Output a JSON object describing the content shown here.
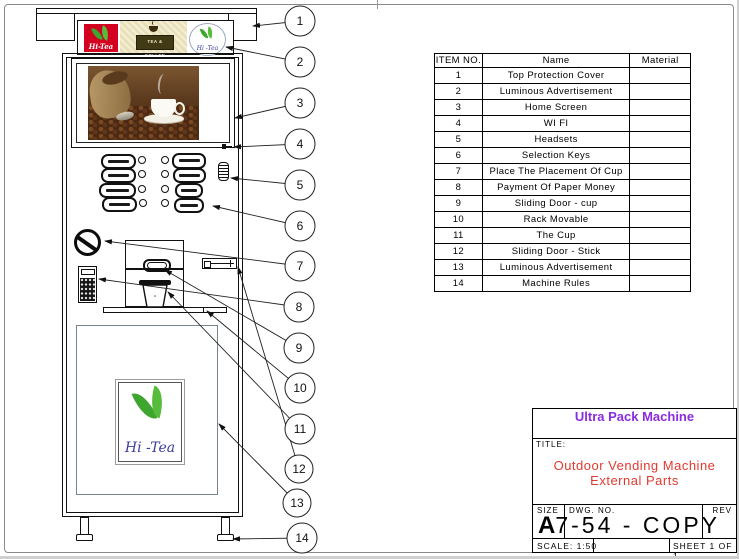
{
  "callouts": [
    "1",
    "2",
    "3",
    "4",
    "5",
    "6",
    "7",
    "8",
    "9",
    "10",
    "11",
    "12",
    "13",
    "14"
  ],
  "parts_table": {
    "headers": [
      "ITEM NO.",
      "Name",
      "Material"
    ],
    "rows": [
      [
        "1",
        "Top Protection Cover",
        ""
      ],
      [
        "2",
        "Luminous Advertisement",
        ""
      ],
      [
        "3",
        "Home Screen",
        ""
      ],
      [
        "4",
        "WI FI",
        ""
      ],
      [
        "5",
        "Headsets",
        ""
      ],
      [
        "6",
        "Selection Keys",
        ""
      ],
      [
        "7",
        "Place The Placement Of Cup",
        ""
      ],
      [
        "8",
        "Payment Of Paper Money",
        ""
      ],
      [
        "9",
        "Sliding Door - cup",
        ""
      ],
      [
        "10",
        "Rack Movable",
        ""
      ],
      [
        "11",
        "The Cup",
        ""
      ],
      [
        "12",
        "Sliding Door - Stick",
        ""
      ],
      [
        "13",
        "Luminous Advertisement",
        ""
      ],
      [
        "14",
        "Machine Rules",
        ""
      ]
    ]
  },
  "title_block": {
    "company": "Ultra Pack Machine",
    "title_label": "TITLE:",
    "title_line1": "Outdoor Vending Machine",
    "title_line2": "External Parts",
    "size_label": "SIZE",
    "size_value": "A",
    "dwg_label": "DWG.  NO.",
    "dwg_value": "7-54 - COPY",
    "rev_label": "REV",
    "scale": "SCALE: 1:50",
    "sheet": "SHEET 1 OF 1"
  },
  "branding": {
    "red_logo_text": "Hi-Tea",
    "badge_text": "TEA & COFFEE",
    "circle_logo_text": "Hi -Tea",
    "panel_logo_text": "Hi -Tea"
  },
  "colors": {
    "company_purple": "#8a2be2",
    "title_red": "#e03a30",
    "logo_red": "#d40020",
    "leaf_green": "#3ea52e",
    "script_blue": "#3d3da0",
    "strip_beige": "#eae0b8",
    "drawing_line": "#111111"
  }
}
